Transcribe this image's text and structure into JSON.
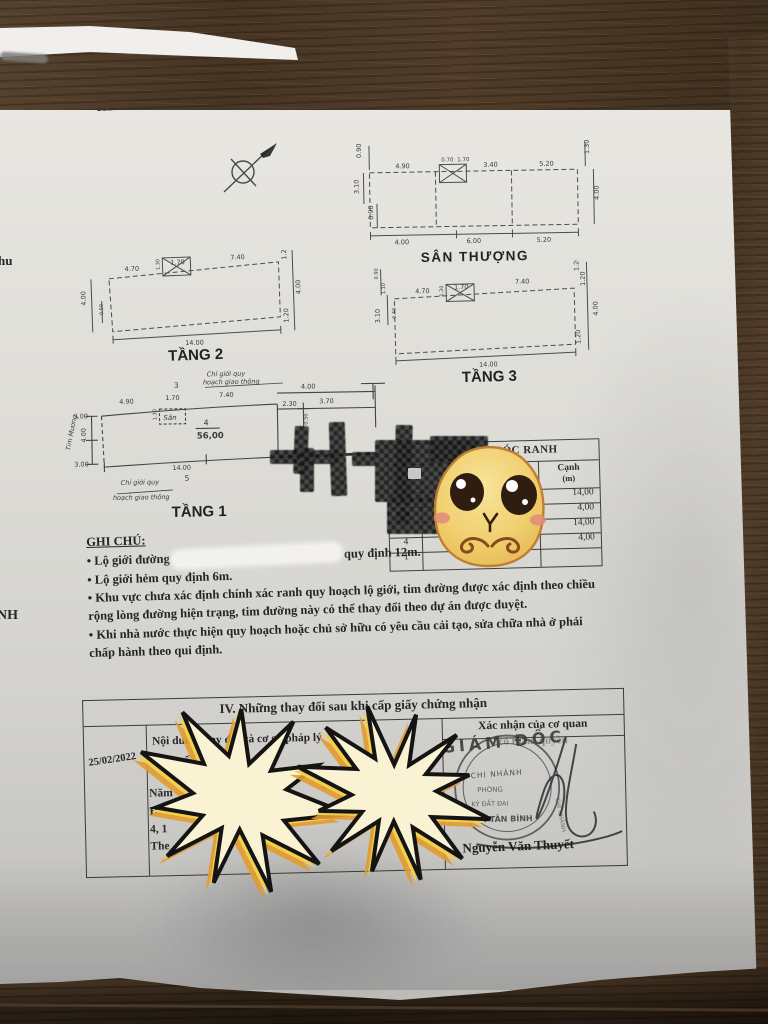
{
  "title": {
    "section3": "III. Sơ đồ thửa đất, nhà ở và tài sản khác gắn liền với thửa đất"
  },
  "edge": {
    "left_top": "hu",
    "left_bottom": "NH"
  },
  "plans": {
    "san_thuong": {
      "label": "SÂN THƯỢNG",
      "top_dims": [
        "4.90",
        "0.70",
        "1.70",
        "3.40",
        "5.20"
      ],
      "bottom_dims": [
        "4.00",
        "6.00",
        "5.20"
      ],
      "left_dims": [
        "0.90",
        "3.10",
        "0.90"
      ],
      "right_dims": [
        "1.30",
        "4.00"
      ]
    },
    "tang2": {
      "label": "TẦNG 2",
      "top_dims": [
        "4.70",
        "1.70",
        "7.40"
      ],
      "bottom_dims": [
        "14.00"
      ],
      "left_dims": [
        "4.00",
        "0.50"
      ],
      "right_dims": [
        "1.20",
        "4.00",
        "1.20"
      ],
      "xbox_dim": "1.30"
    },
    "tang3": {
      "label": "TẦNG 3",
      "top_dims": [
        "4.70",
        "1.70",
        "7.40"
      ],
      "bottom_dims": [
        "14.00"
      ],
      "left_dims": [
        "0.90",
        "1.10",
        "3.10",
        "0.40"
      ],
      "right_dims": [
        "1.20",
        "1.20",
        "4.00",
        "1.20"
      ],
      "xbox_dim": "1.30"
    },
    "tang1": {
      "label": "TẦNG 1",
      "top_dims": [
        "4.90",
        "1.70",
        "7.40"
      ],
      "right_top_dims": [
        "4.00",
        "2.30",
        "3.70"
      ],
      "small_dim": "0.50",
      "left_dims": [
        "3.00",
        "4.00",
        "3.00"
      ],
      "bottom_dims": [
        "14.00"
      ],
      "lot_number": "4",
      "area": "56,00",
      "point_top": "3",
      "point_bottom": "5",
      "san_label": "Sân",
      "san_dim": "1.30",
      "note_line1": "Chỉ giới quy",
      "note_line2": "hoạch giao thông",
      "tim_label": "Tim Mương"
    }
  },
  "ranh_table": {
    "title": "GÓC RANH",
    "canh_header_1": "Cạnh",
    "canh_header_2": "(m)",
    "rows": [
      {
        "goc": "1",
        "canh": "14,00"
      },
      {
        "goc": "2",
        "canh": "4,00"
      },
      {
        "goc": "3",
        "canh": "14,00"
      },
      {
        "goc": "4",
        "canh": "4,00"
      },
      {
        "goc": "1",
        "canh": ""
      }
    ]
  },
  "ghi_chu": {
    "heading": "GHI CHÚ:",
    "bullet": "•",
    "item1_pre": "Lộ giới đường",
    "item1_post": "quy định 12m.",
    "item2": "Lộ giới hẻm quy định 6m.",
    "item3": "Khu vực chưa xác định chính xác ranh quy hoạch lộ giới, tim đường được xác định theo chiều rộng lòng đường hiện trạng, tim đường này có thể thay đổi theo dự án được duyệt.",
    "item4": "Khi nhà nước thực hiện quy hoạch hoặc chủ sở hữu có yêu cầu cải tạo, sửa chữa nhà ở phải chấp hành theo qui định."
  },
  "section4": {
    "title": "IV. Những thay đổi sau khi cấp giấy chứng nhận",
    "date": "25/02/2022",
    "left_header": "Nội dung thay đổi và cơ sở pháp lý",
    "fragments": [
      "• Chuyể",
      "Năm",
      "Đi",
      "4, 1",
      "The"
    ],
    "frag_mid": "01",
    "right_header": "Xác nhận của cơ quan",
    "right_header2": "có thẩm quyền",
    "stamp_title": "GIÁM ĐỐC",
    "stamp_ring1": "CHI NHÁNH",
    "stamp_ring2": "PHÒNG",
    "stamp_ring3": "KÝ ĐẤT ĐAI",
    "stamp_ring4": "VĂN TÂN BÌNH",
    "signature_name": "Nguyễn Văn Thuyết"
  }
}
